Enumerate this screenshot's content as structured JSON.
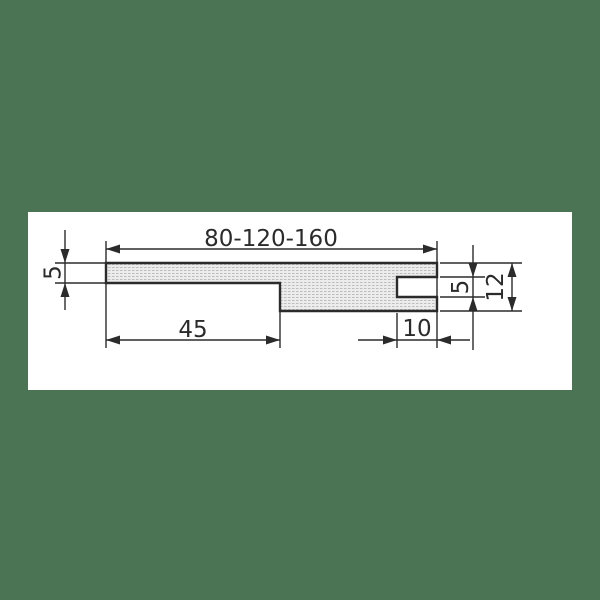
{
  "colors": {
    "background": "#4b7455",
    "canvas": "#ffffff",
    "line": "#2b2b2b",
    "hatch_fill": "#ececec",
    "hatch_dot": "#bdbdbd"
  },
  "drawing": {
    "dimensions": {
      "overall_width_label": "80-120-160",
      "top_thickness_label": "5",
      "left_segment_label": "45",
      "notch_depth_label": "10",
      "notch_height_label": "5",
      "right_thickness_label": "12"
    }
  }
}
